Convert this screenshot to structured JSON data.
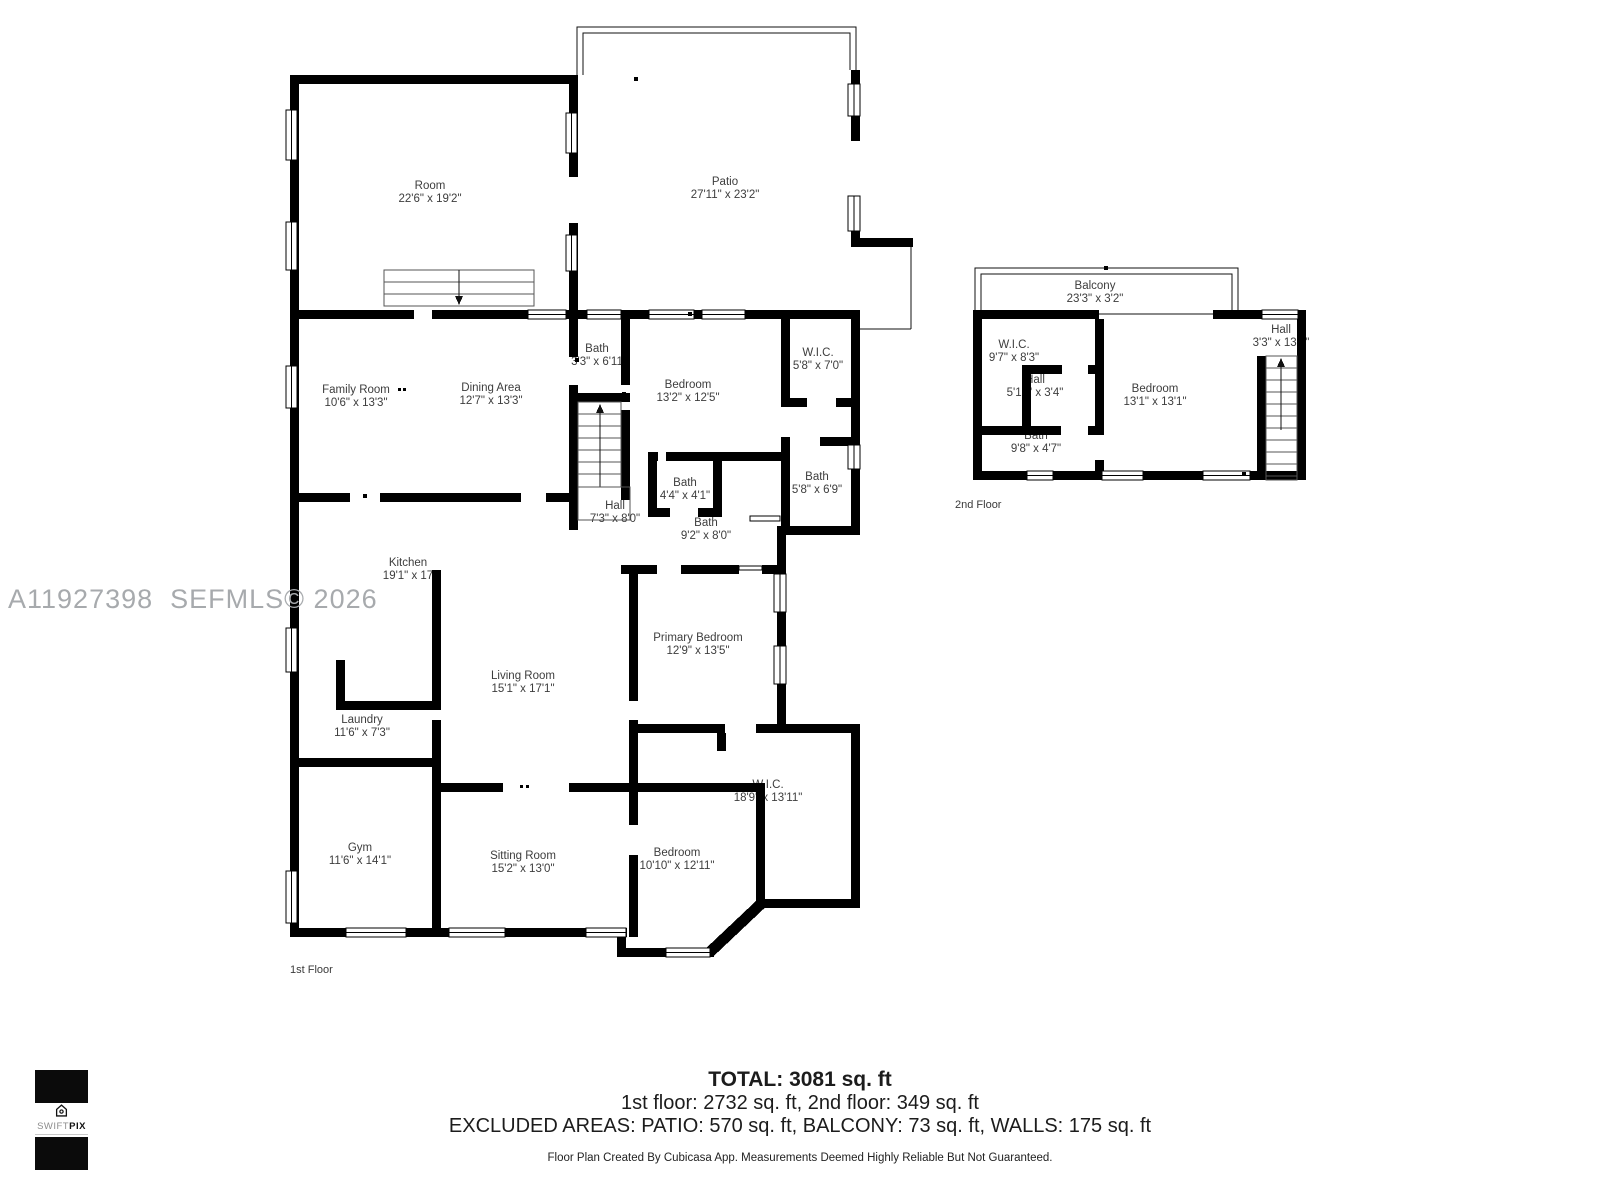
{
  "watermark": "A11927398  SEFMLS© 2026",
  "floors": {
    "floor1": {
      "label": "1st Floor"
    },
    "floor2": {
      "label": "2nd Floor"
    }
  },
  "rooms": {
    "room": {
      "name": "Room",
      "dims": "22'6\" x 19'2\""
    },
    "patio": {
      "name": "Patio",
      "dims": "27'11\" x 23'2\""
    },
    "family_room": {
      "name": "Family Room",
      "dims": "10'6\" x 13'3\""
    },
    "dining_area": {
      "name": "Dining Area",
      "dims": "12'7\" x 13'3\""
    },
    "bath_hall_small": {
      "name": "Bath",
      "dims": "3'3\" x 6'11"
    },
    "bedroom_front": {
      "name": "Bedroom",
      "dims": "13'2\" x 12'5\""
    },
    "wic_front": {
      "name": "W.I.C.",
      "dims": "5'8\" x 7'0\""
    },
    "bath_tiny": {
      "name": "Bath",
      "dims": "4'4\" x 4'1\""
    },
    "bath_right": {
      "name": "Bath",
      "dims": "5'8\" x 6'9\""
    },
    "hall_main": {
      "name": "Hall",
      "dims": "7'3\" x 8'0\""
    },
    "bath_center": {
      "name": "Bath",
      "dims": "9'2\" x 8'0\""
    },
    "kitchen": {
      "name": "Kitchen",
      "dims": "19'1\" x 17"
    },
    "primary_bedroom": {
      "name": "Primary Bedroom",
      "dims": "12'9\" x 13'5\""
    },
    "living_room": {
      "name": "Living Room",
      "dims": "15'1\" x 17'1\""
    },
    "laundry": {
      "name": "Laundry",
      "dims": "11'6\" x 7'3\""
    },
    "wic_big": {
      "name": "W.I.C.",
      "dims": "18'9\" x 13'11\""
    },
    "gym": {
      "name": "Gym",
      "dims": "11'6\" x 14'1\""
    },
    "sitting_room": {
      "name": "Sitting Room",
      "dims": "15'2\" x 13'0\""
    },
    "bedroom_bottom": {
      "name": "Bedroom",
      "dims": "10'10\" x 12'11\""
    },
    "balcony": {
      "name": "Balcony",
      "dims": "23'3\" x 3'2\""
    },
    "wic_2f": {
      "name": "W.I.C.",
      "dims": "9'7\" x 8'3\""
    },
    "hall_2f": {
      "name": "Hall",
      "dims": "5'10\" x 3'4\""
    },
    "bedroom_2f": {
      "name": "Bedroom",
      "dims": "13'1\" x 13'1\""
    },
    "hall_stairs_2f": {
      "name": "Hall",
      "dims": "3'3\" x 13'1\""
    },
    "bath_2f": {
      "name": "Bath",
      "dims": "9'8\" x 4'7\""
    }
  },
  "summary": {
    "total": "TOTAL: 3081 sq. ft",
    "floors_line": "1st floor: 2732 sq. ft, 2nd floor: 349 sq. ft",
    "excluded_line": "EXCLUDED AREAS: PATIO: 570 sq. ft, BALCONY: 73 sq. ft, WALLS: 175 sq. ft",
    "disclaimer": "Floor Plan Created By Cubicasa App. Measurements Deemed Highly Reliable But Not Guaranteed."
  },
  "logo": {
    "brand_light": "SWIFT",
    "brand_bold": "PIX"
  },
  "colors": {
    "wall": "#000000",
    "label": "#3d3d3d",
    "watermark": "#a7aaad"
  }
}
